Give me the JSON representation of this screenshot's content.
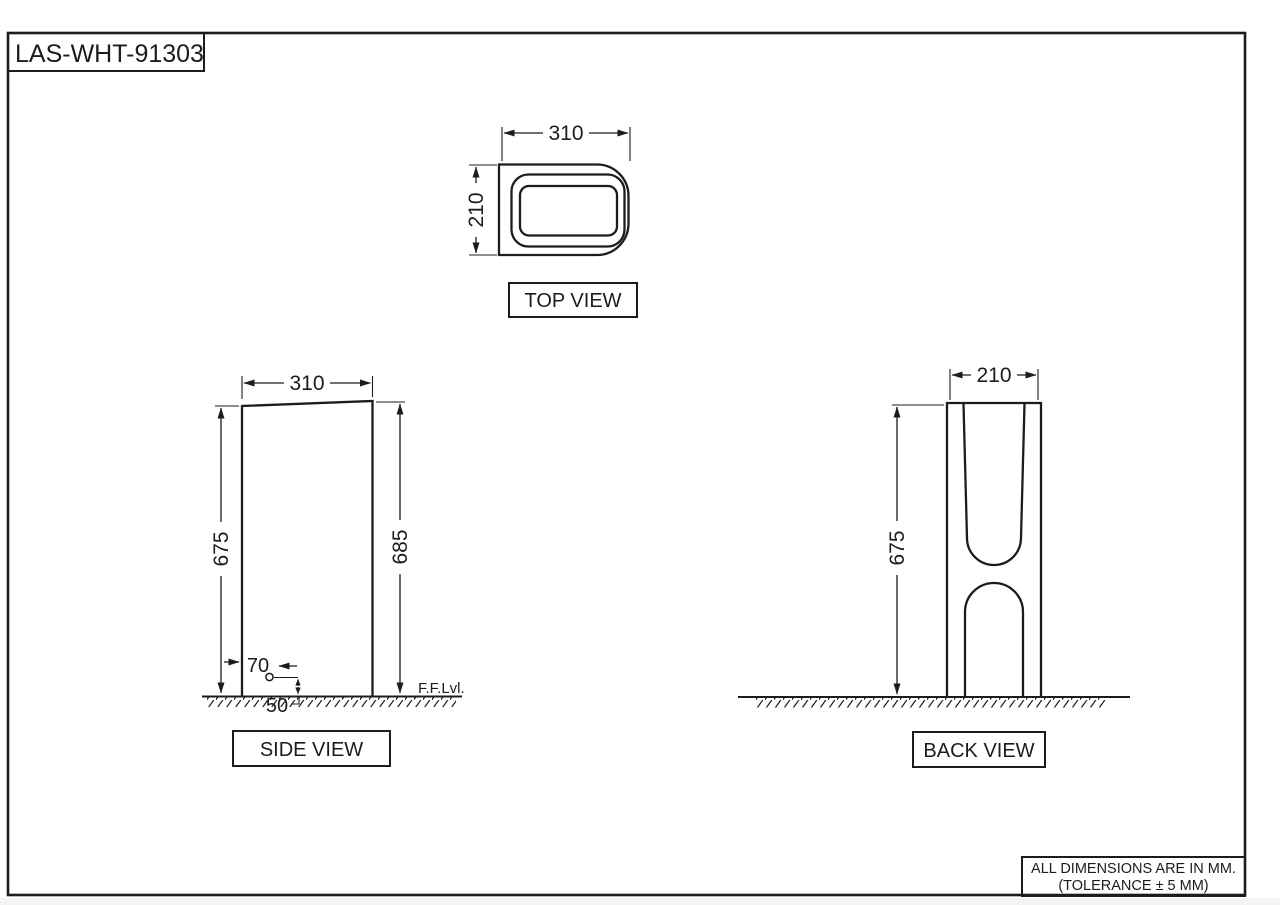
{
  "title": "LAS-WHT-91303",
  "views": {
    "top": {
      "label": "TOP VIEW",
      "width": "310",
      "depth": "210"
    },
    "side": {
      "label": "SIDE VIEW",
      "width": "310",
      "height_left": "675",
      "height_right": "685",
      "hole_offset": "70",
      "hole_height": "50",
      "floor_level": "F.F.Lvl."
    },
    "back": {
      "label": "BACK VIEW",
      "width": "210",
      "height": "675"
    }
  },
  "note": {
    "line1": "ALL DIMENSIONS ARE IN MM.",
    "line2": "(TOLERANCE ± 5 MM)"
  },
  "colors": {
    "line": "#1c1c1c",
    "background": "#ffffff"
  }
}
